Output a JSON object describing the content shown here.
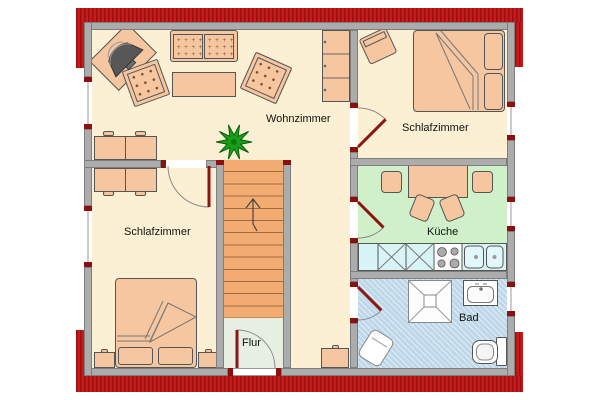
{
  "floorplan": {
    "rooms": {
      "living_room": "Wohnzimmer",
      "bedroom_upper": "Schlafzimmer",
      "kitchen": "Küche",
      "bathroom": "Bad",
      "bedroom_lower": "Schlafzimmer",
      "hallway": "Flur"
    },
    "furniture": [
      "tv-icon",
      "sofa",
      "armchair",
      "coffee-table",
      "sideboard",
      "wardrobe",
      "plant-icon",
      "double-bed",
      "pillow",
      "stool",
      "dining-table",
      "chair",
      "kitchen-counter",
      "stove-icon",
      "sink-icon",
      "shower-icon",
      "washbasin-icon",
      "toilet-icon",
      "laundry-basket",
      "nightstand",
      "dresser",
      "stairs",
      "stairs-direction-arrow",
      "door",
      "window"
    ],
    "colors": {
      "roof_red": "#C91A1A",
      "roof_stripe_dark": "#9A0F0F",
      "wall_gray": "#ACACAC",
      "floor_cream": "#FBF0D3",
      "kitchen_green": "#CFF0C8",
      "hallway_green": "#E7EFE2",
      "bathroom_blue": "#BFD8E9",
      "counter_cyan": "#D8F4F6",
      "furniture_peach": "#F5C6A0",
      "stairs_orange": "#F2AC72",
      "door_leaf_red": "#8C1512",
      "plant_green": "#17A017"
    }
  }
}
